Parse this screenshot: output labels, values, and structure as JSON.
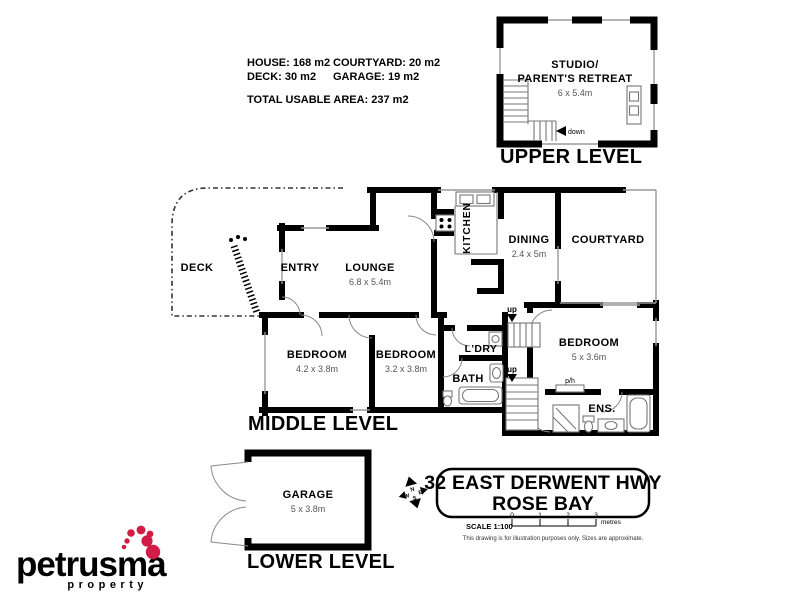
{
  "stats": {
    "house": "HOUSE: 168 m2",
    "courtyard": "COURTYARD: 20 m2",
    "deck": "DECK: 30 m2",
    "garage": "GARAGE: 19 m2",
    "total": "TOTAL USABLE AREA: 237 m2"
  },
  "upper_level": {
    "title": "UPPER LEVEL",
    "room_line1": "STUDIO/",
    "room_line2": "PARENT'S RETREAT",
    "room_size": "6 x 5.4m",
    "down_label": "down"
  },
  "middle_level": {
    "title": "MIDDLE LEVEL",
    "deck": "DECK",
    "entry": "ENTRY",
    "lounge": "LOUNGE",
    "lounge_size": "6.8 x 5.4m",
    "kitchen": "KITCHEN",
    "dining": "DINING",
    "dining_size": "2.4 x 5m",
    "courtyard": "COURTYARD",
    "bedroom1": "BEDROOM",
    "bedroom1_size": "4.2 x 3.8m",
    "bedroom2": "BEDROOM",
    "bedroom2_size": "3.2 x 3.8m",
    "bedroom3": "BEDROOM",
    "bedroom3_size": "5 x 3.6m",
    "laundry": "L'DRY",
    "bath": "BATH",
    "ensuite": "ENS.",
    "ph": "p/h",
    "up1": "up",
    "up2": "up"
  },
  "lower_level": {
    "title": "LOWER LEVEL",
    "garage": "GARAGE",
    "garage_size": "5 x 3.8m"
  },
  "address": {
    "line1": "32 EAST DERWENT HWY",
    "line2": "ROSE BAY"
  },
  "scale_bar": {
    "label": "SCALE 1:100",
    "ticks": [
      "0",
      "1",
      "2",
      "3"
    ],
    "unit": "metres",
    "disclaimer": "This drawing is for illustration purposes only. Sizes are approximate."
  },
  "compass": {
    "n": "N",
    "e": "E",
    "s": "S",
    "w": "W"
  },
  "logo": {
    "name": "petrusma",
    "tagline": "property",
    "text_color": "#262e3f",
    "dot_color": "#d11d46"
  }
}
